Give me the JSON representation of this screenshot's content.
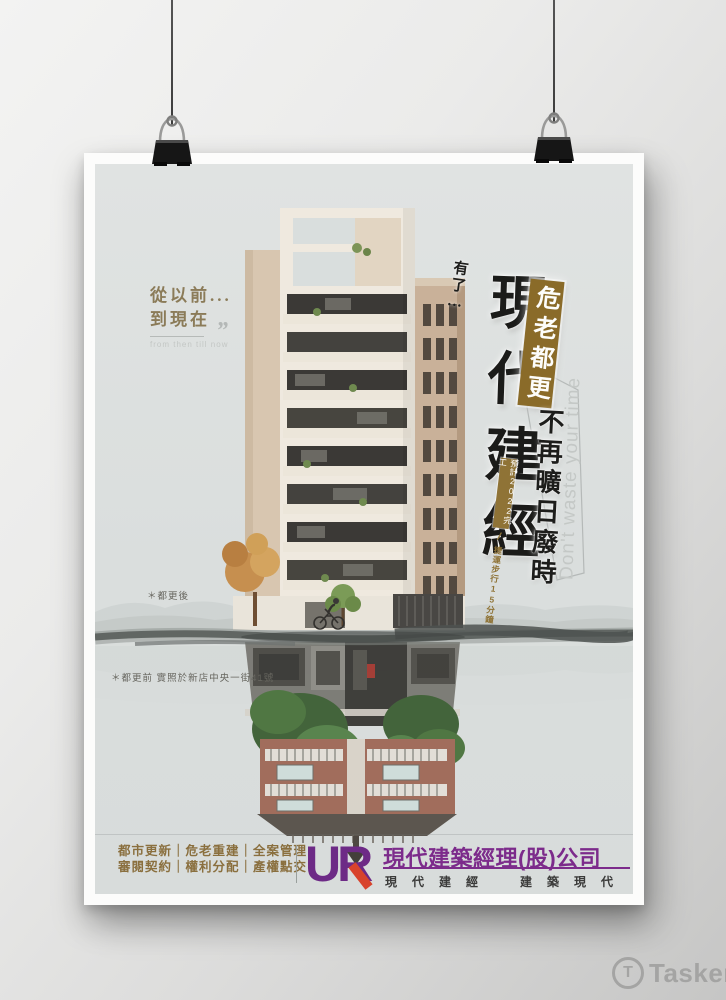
{
  "watermark": {
    "brand": "Tasker",
    "icon": "tasker-circle-t-icon"
  },
  "poster": {
    "intro": {
      "line1": "從以前...",
      "line2": "到現在",
      "quote_mark": "”",
      "caption_en": "from then till now"
    },
    "headline": {
      "prefix": "有了…",
      "main": "現代建經",
      "ribbon": "危老都更",
      "subline": "不再曠日廢時",
      "tagline_en": "Don't waste your time",
      "note_box": "預計2022完工",
      "note_divider": "/",
      "note_tail": "捷運步行15分鐘"
    },
    "photo_labels": {
      "after": "＊都更後",
      "before": "＊都更前 實照於新店中央一街41號"
    },
    "footer": {
      "services_line1": "都市更新｜危老重建｜全案管理",
      "services_line2": "審閱契約｜權利分配｜產權點交",
      "logo_text": "UR",
      "company_name": "現代建築經理(股)公司",
      "slogan": "現代建經　建築現代"
    },
    "colors": {
      "ribbon_gold": "#8a6b29",
      "text_gold": "#8a6f3e",
      "brand_purple": "#7c2b8b",
      "logo_red": "#d8432c",
      "ink_black": "#1d1d1b",
      "print_bg": "#dcdfde"
    }
  }
}
